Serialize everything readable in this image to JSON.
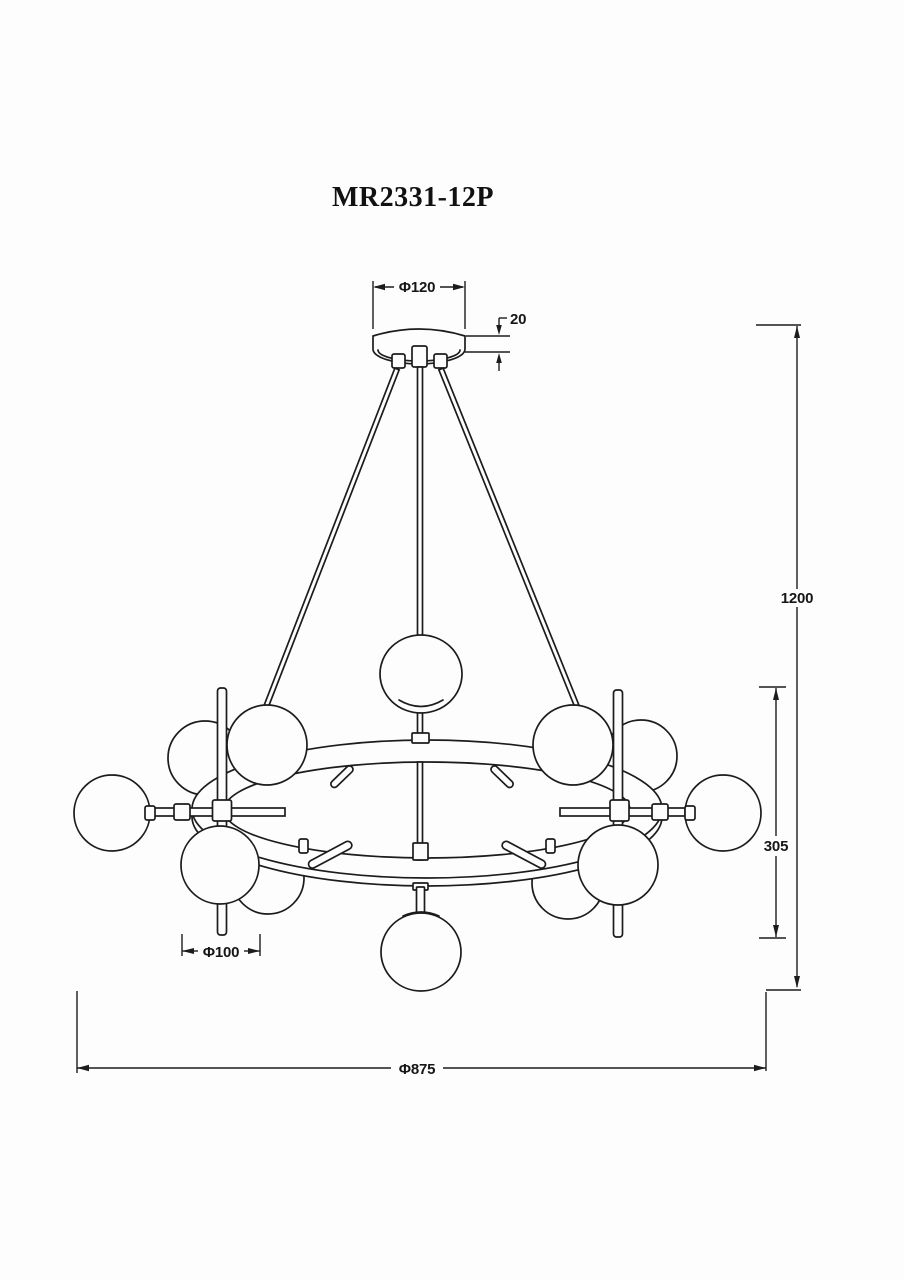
{
  "page": {
    "background": "#fdfdfd",
    "ink_color": "#1c1c1c",
    "kind": "product dimensional line drawing",
    "subject": "12-lamp ring chandelier, front elevation"
  },
  "drawing": {
    "title": "MR2331-12P",
    "dimensions": {
      "canopy_diameter": {
        "label": "Φ120",
        "value": 120
      },
      "canopy_height": {
        "label": "20",
        "value": 20
      },
      "overall_height": {
        "label": "1200",
        "value": 1200
      },
      "body_height": {
        "label": "305",
        "value": 305
      },
      "lamp_diameter": {
        "label": "Φ100",
        "value": 100
      },
      "overall_diameter": {
        "label": "Φ875",
        "value": 875
      }
    }
  }
}
